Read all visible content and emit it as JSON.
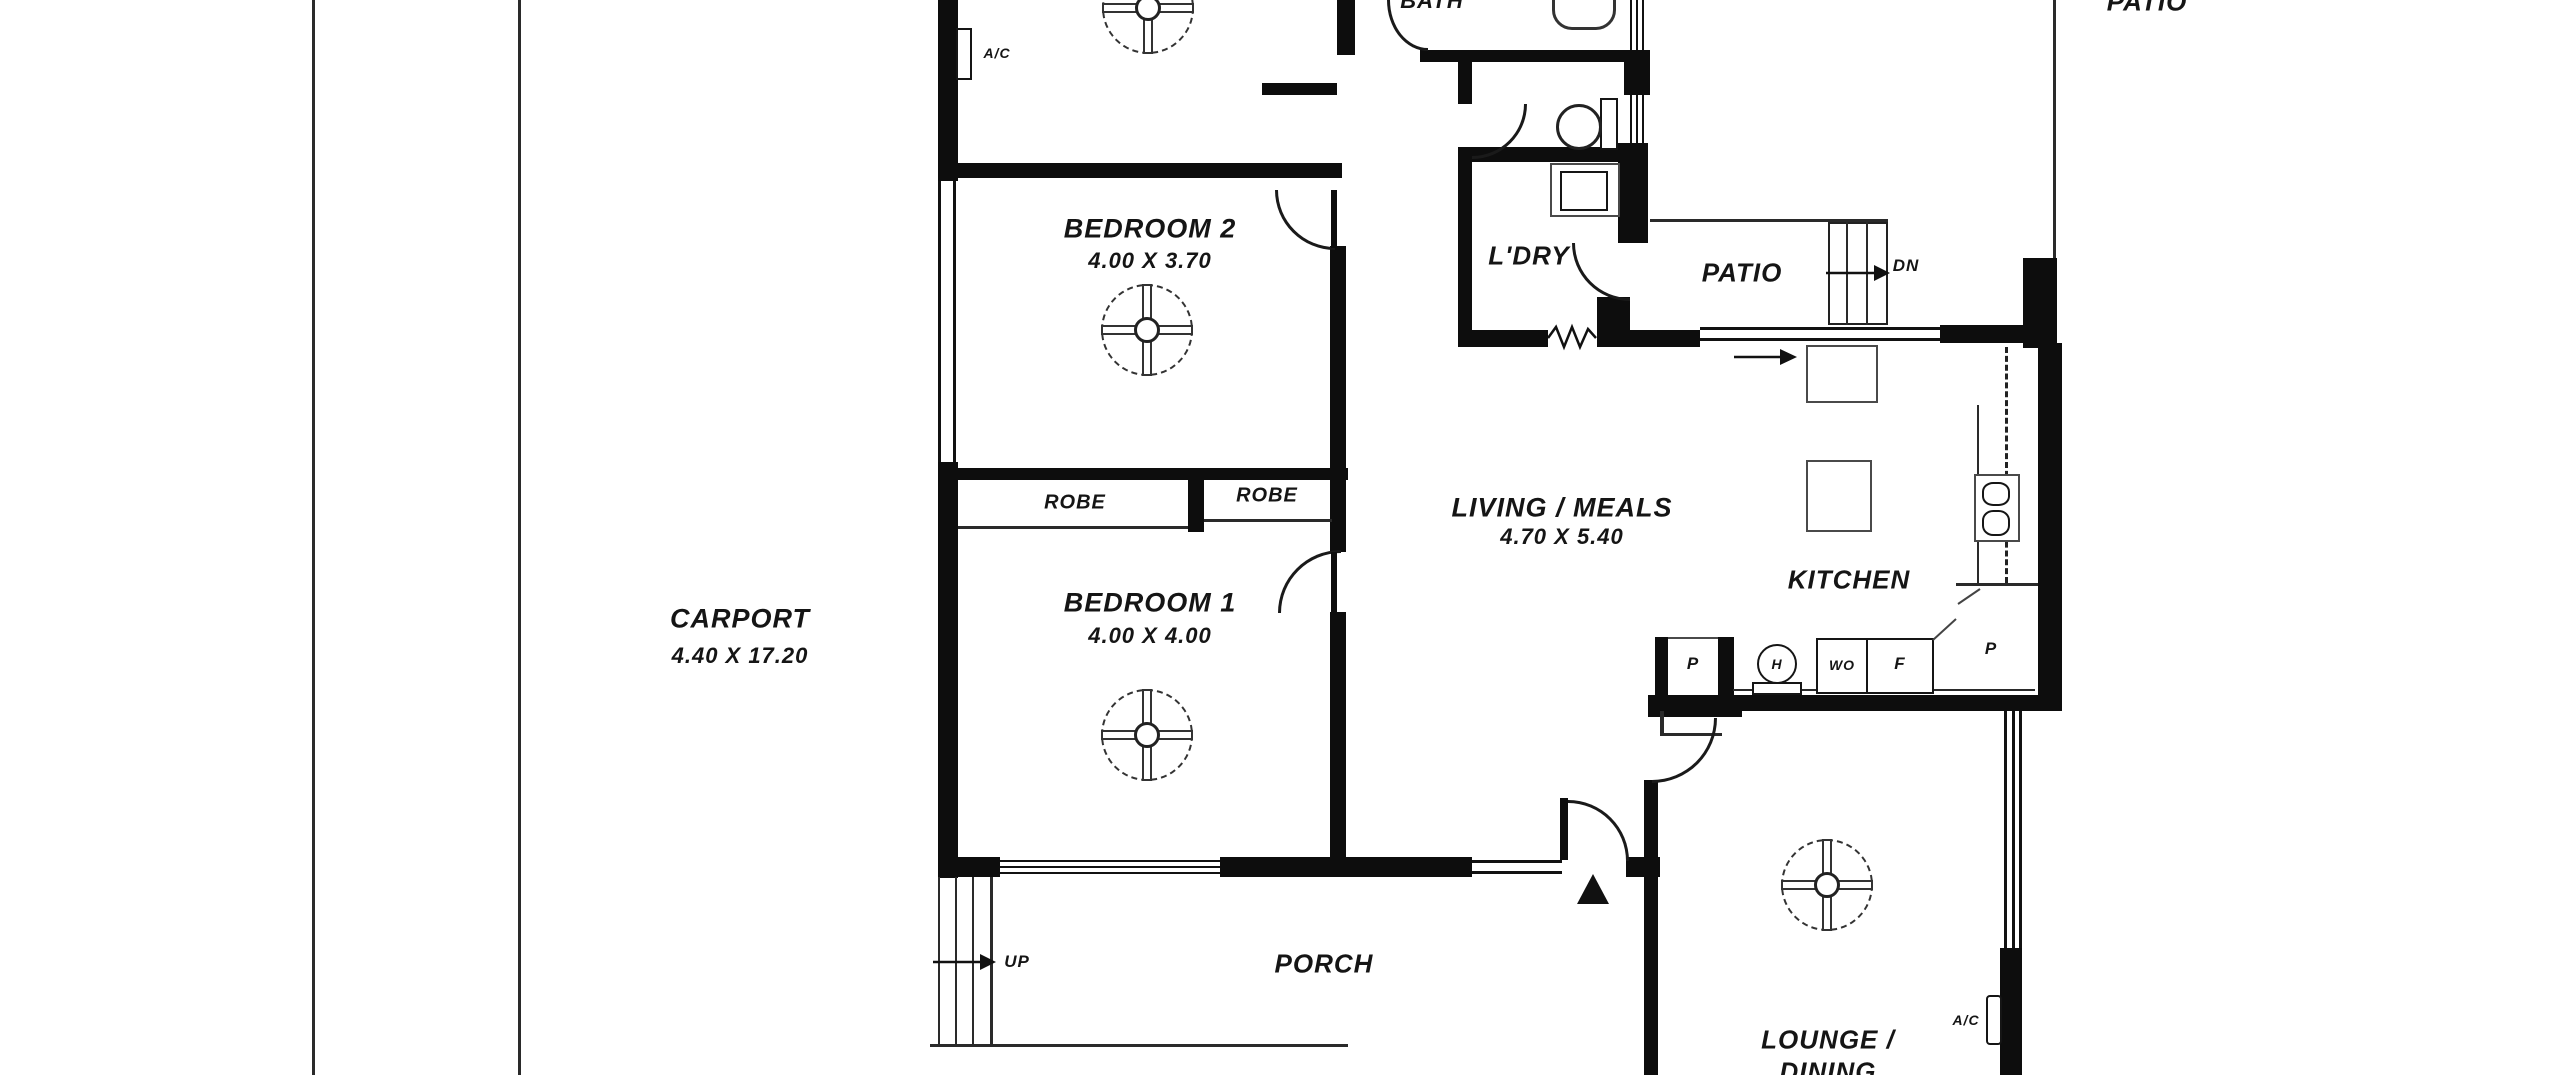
{
  "canvas": {
    "bg": "#ffffff",
    "wall_color": "#0d0d0d"
  },
  "rooms": {
    "carport": {
      "name": "CARPORT",
      "dims": "4.40 X 17.20"
    },
    "bedroom2": {
      "name": "BEDROOM 2",
      "dims": "4.00 X 3.70"
    },
    "bedroom1": {
      "name": "BEDROOM 1",
      "dims": "4.00 X 4.00"
    },
    "living_meals": {
      "name": "LIVING / MEALS",
      "dims": "4.70 X 5.40"
    },
    "kitchen": {
      "name": "KITCHEN"
    },
    "laundry": {
      "name": "L'DRY"
    },
    "bath": {
      "name": "BATH"
    },
    "patio_middle": {
      "name": "PATIO"
    },
    "patio_top": {
      "name": "PATIO"
    },
    "porch": {
      "name": "PORCH"
    },
    "lounge_dining": {
      "name": "LOUNGE /",
      "name_line2": "DINING"
    }
  },
  "storage": {
    "robe_left": "ROBE",
    "robe_right": "ROBE"
  },
  "fixtures": {
    "ac_unit_top": "A/C",
    "ac_unit_lounge": "A/C"
  },
  "stairs_labels": {
    "up": "UP",
    "down": "DN"
  },
  "appliances": {
    "pantry_left": "P",
    "hot_water": "H",
    "wall_oven": "WO",
    "fridge": "F",
    "pantry_corner": "P"
  }
}
